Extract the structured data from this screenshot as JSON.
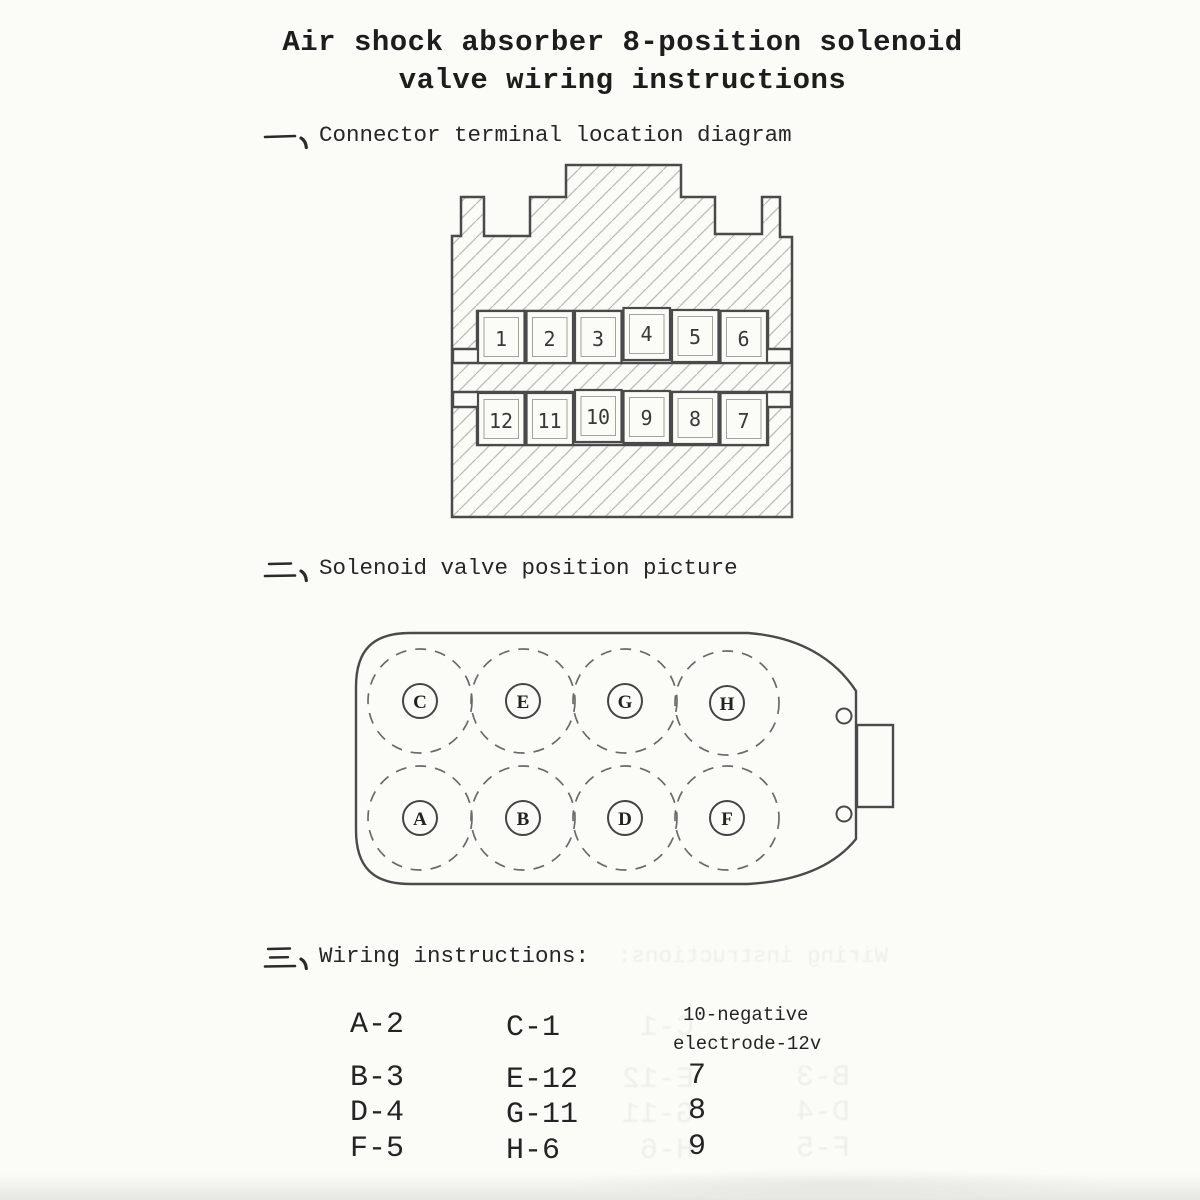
{
  "title": {
    "line1": "Air shock absorber 8-position solenoid",
    "line2": "valve wiring instructions"
  },
  "sections": [
    {
      "marker": "一、",
      "heading": "Connector terminal location diagram"
    },
    {
      "marker": "二、",
      "heading": "Solenoid valve position picture"
    },
    {
      "marker": "三、",
      "heading": "Wiring instructions:"
    }
  ],
  "connector": {
    "top_row_terminals": [
      "1",
      "2",
      "3",
      "4",
      "5",
      "6"
    ],
    "bottom_row_terminals": [
      "12",
      "11",
      "10",
      "9",
      "8",
      "7"
    ]
  },
  "valve": {
    "top_row_solenoids": [
      "C",
      "E",
      "G",
      "H"
    ],
    "bottom_row_solenoids": [
      "A",
      "B",
      "D",
      "F"
    ]
  },
  "wiring": {
    "column1": [
      "A-2",
      "B-3",
      "D-4",
      "F-5"
    ],
    "column2": [
      "C-1",
      "E-12",
      "G-11",
      "H-6"
    ],
    "note_line1": "10-negative",
    "note_line2": "electrode-12v",
    "column3": [
      "7",
      "8",
      "9"
    ]
  },
  "colors": {
    "paper": "#fbfbf8",
    "line": "#4a4a4a",
    "hatch": "#bcbcb4",
    "text": "#2a2a2a",
    "ghost": "#6e6e55"
  }
}
